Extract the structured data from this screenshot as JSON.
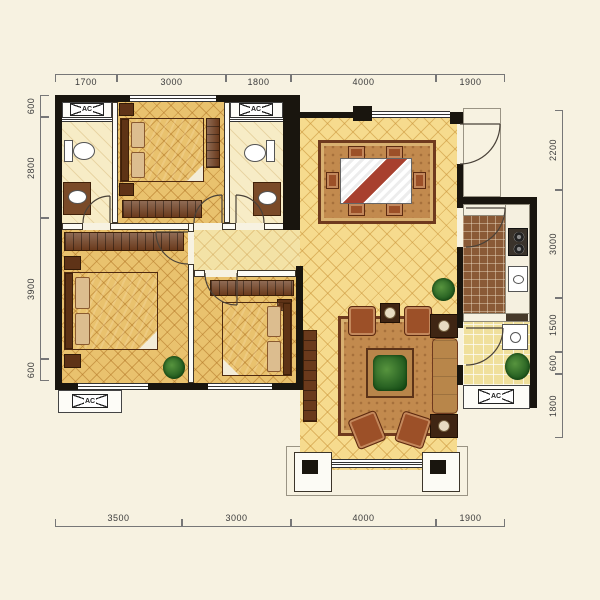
{
  "plan": {
    "type": "apartment-floor-plan"
  },
  "labels": {
    "ac": "AC"
  },
  "dimensions": {
    "top": [
      "1700",
      "3000",
      "1800",
      "4000",
      "1900"
    ],
    "bottom": [
      "3500",
      "3000",
      "4000",
      "1900"
    ],
    "left": [
      "600",
      "2800",
      "3900",
      "600"
    ],
    "right": [
      "2200",
      "3000",
      "1500",
      "600",
      "1800"
    ]
  },
  "colors": {
    "background": "#f7f2e1",
    "wall": "#19150e",
    "floor_living_dining": "#f6db8e",
    "floor_bedroom": "#e9c26e",
    "floor_bath": "#f7ecc6",
    "floor_hall": "#f3e2a6",
    "floor_kitchen": "#8a5a36",
    "floor_service_balcony": "#f0e09c",
    "rug": "#c28a4e",
    "plant": "#2f6b2b"
  }
}
